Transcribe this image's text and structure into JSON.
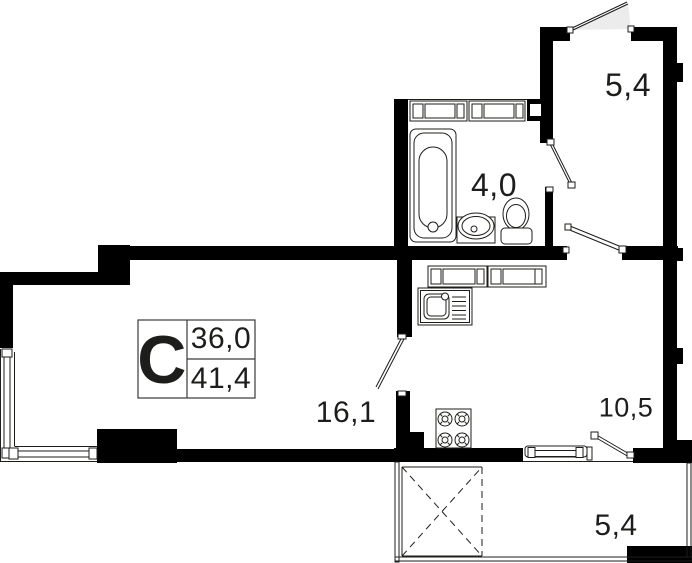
{
  "compass": {
    "letter": "С"
  },
  "legend": {
    "values": [
      "36,0",
      "41,4"
    ]
  },
  "rooms": [
    {
      "id": "hallway",
      "area": "5,4"
    },
    {
      "id": "bathroom",
      "area": "4,0"
    },
    {
      "id": "living-room",
      "area": "16,1"
    },
    {
      "id": "kitchen",
      "area": "10,5"
    },
    {
      "id": "balcony",
      "area": "5,4"
    }
  ],
  "colors": {
    "wall": "#000000",
    "line": "#1d1d1b",
    "door_swing_fill": "#ececec",
    "background": "#ffffff"
  },
  "fixtures": [
    "bathtub",
    "washbasin",
    "toilet",
    "wardrobe-cabinets",
    "kitchen-counter",
    "kitchen-sink",
    "stove-4-burner",
    "window",
    "balcony-door",
    "balcony-hatch"
  ]
}
